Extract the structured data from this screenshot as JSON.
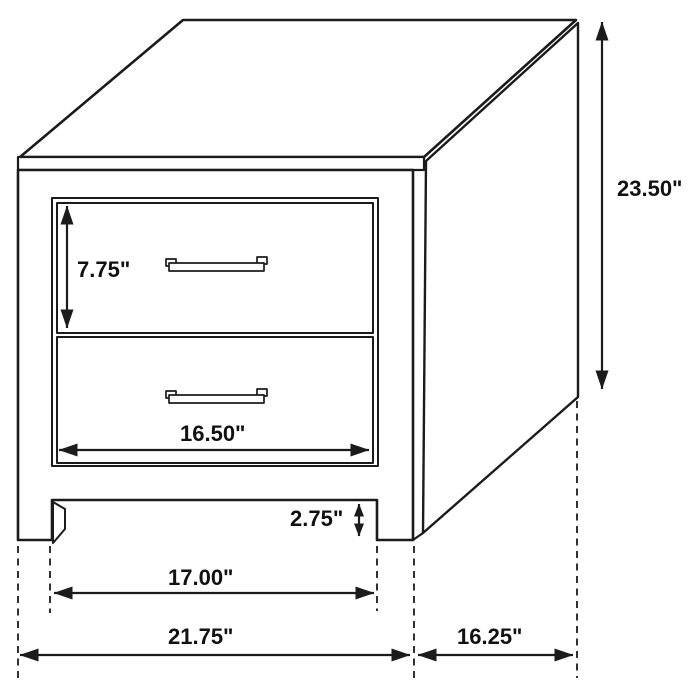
{
  "diagram": {
    "unit": "inches",
    "background_color": "#ffffff",
    "line_color": "#1b1b1b",
    "labels": {
      "overall_height": "23.50\"",
      "top_drawer_height": "7.75\"",
      "drawer_opening_width": "16.50\"",
      "base_clearance": "2.75\"",
      "inner_leg_span": "17.00\"",
      "overall_width": "21.75\"",
      "side_depth": "16.25\""
    },
    "values": {
      "overall_height_in": 23.5,
      "top_drawer_height_in": 7.75,
      "drawer_opening_width_in": 16.5,
      "base_clearance_in": 2.75,
      "inner_leg_span_in": 17.0,
      "overall_width_in": 21.75,
      "side_depth_in": 16.25
    }
  }
}
